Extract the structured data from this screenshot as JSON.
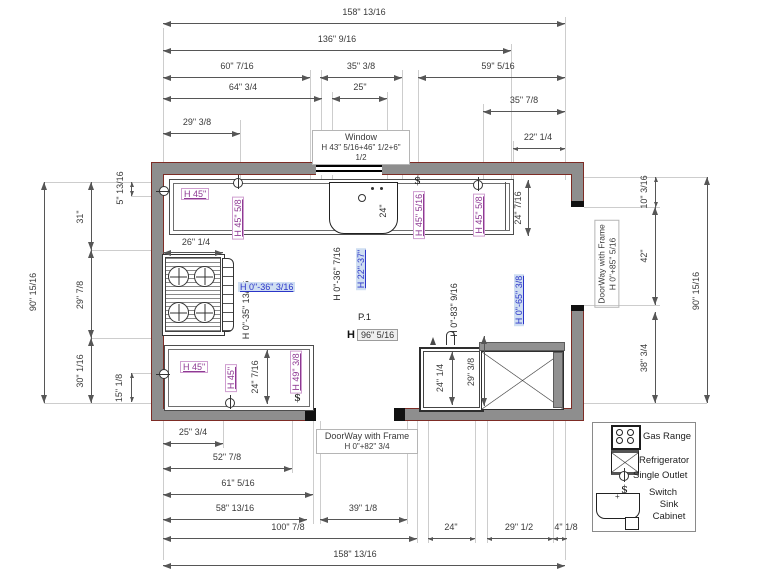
{
  "dims": {
    "top_total": "158\" 13/16",
    "top_136": "136\" 9/16",
    "top_60": "60\" 7/16",
    "top_35a": "35\" 3/8",
    "top_59": "59\" 5/16",
    "top_64": "64\" 3/4",
    "top_25": "25\"",
    "top_35b": "35\" 7/8",
    "top_29": "29\" 3/8",
    "top_22": "22\" 1/4",
    "left_total": "90\" 15/16",
    "left_31": "31\"",
    "left_29": "29\" 7/8",
    "left_30": "30\" 1/16",
    "left_5": "5\" 13/16",
    "left_15": "15\" 1/8",
    "right_10": "10\" 3/16",
    "right_42": "42\"",
    "right_38": "38\" 3/4",
    "right_total": "90\" 15/16",
    "bottom_25": "25\" 3/4",
    "bottom_52": "52\" 7/8",
    "bottom_61": "61\" 5/16",
    "bottom_58": "58\" 13/16",
    "bottom_39": "39\" 1/8",
    "bottom_100": "100\" 7/8",
    "bottom_24": "24\"",
    "bottom_29": "29\" 1/2",
    "bottom_4": "4\" 1/8",
    "bottom_total": "158\" 13/16",
    "stove_width": "26\" 1/4",
    "sink_depth": "24\"",
    "counter_tr_depth": "24\" 7/16",
    "counter_bl_depth": "24\" 7/16",
    "cabinet_depth": "24\" 1/4",
    "fridge_depth": "29\" 3/8"
  },
  "labels": {
    "window_title": "Window",
    "window_height": "H 43\" 5/16+46\" 1/2+6\" 1/2",
    "door_right_title": "DoorWay with Frame",
    "door_right_height": "H 0\"+85\" 5/16",
    "door_bottom_title": "DoorWay with Frame",
    "door_bottom_height": "H 0\"+82\" 3/4",
    "h45_top_left": "H 45\"",
    "h45_58_top_left": "H 45\" 5/8",
    "h45_516_top_right": "H 45\" 5/16",
    "h45_58_top_right": "H 45\" 5/8",
    "h0_35_1316": "H 0\"-35\" 13/16",
    "h0_36_316": "H 0\"-36\" 3/16",
    "h0_36_716": "H 0\"-36\" 7/16",
    "h22_37": "H 22\"-37\"",
    "room_point": "P.1",
    "h_prefix": "H",
    "h96_516": "96\" 5/16",
    "h0_83_916": "H 0\"-83\" 9/16",
    "h0_65_38": "H 0\"-65\" 3/8",
    "h45_bottom_left": "H 45\"",
    "h45_bottom_left_rot": "H 45\"",
    "h49_38": "H 49\" 3/8"
  },
  "legend": {
    "gas_range": "Gas Range",
    "refrigerator": "Refrigerator",
    "single_outlet": "Single Outlet",
    "switch_label": "Switch",
    "sink_cabinet": "Sink Cabinet"
  },
  "symbols": {
    "switch_glyph": "$"
  },
  "colors": {
    "wall_fill": "#8e8e8e",
    "wall_outline": "#7d2c25",
    "label_purple": "#8e3a93",
    "label_blue": "#2b35c8",
    "highlight_blue_bg": "#cfdef2",
    "dim_gray": "#565656"
  }
}
